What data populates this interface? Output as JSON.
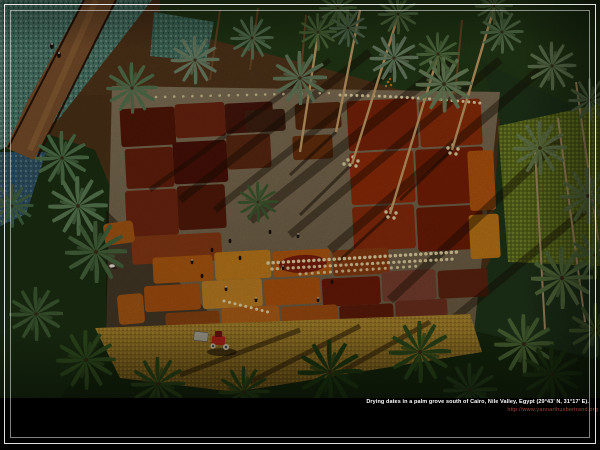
{
  "caption": {
    "line1": "Drying dates in a palm grove south of Cairo, Nile Valley, Egypt (29°43' N, 31°17' E).",
    "url": "http://www.yannarthusbertrand.org"
  },
  "palette": {
    "frame_line": "#ffffff",
    "caption_text": "#ffffff",
    "caption_url": "#9b4a38",
    "caption_band": "#000000",
    "palm_canopy_dark": "#243a16",
    "palm_frond_light": "#6f8568",
    "drying_yard_ground": "#7c6c50",
    "date_patch_maroon": "#5d1c0a",
    "date_patch_rust": "#8a2c0c",
    "date_patch_orange": "#b4560e",
    "date_patch_amber": "#c08024",
    "sack_row_cream": "#ead9a6",
    "cropland_teal": "#4c7a6a",
    "dirt_road_brown": "#7c502c",
    "stubble_gold": "#a8832c",
    "tractor_red": "#b02418"
  }
}
